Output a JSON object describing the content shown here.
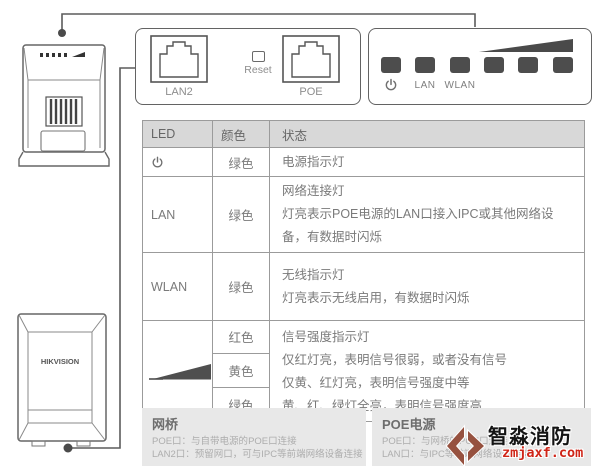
{
  "port_panel": {
    "lan2_label": "LAN2",
    "reset_label": "Reset",
    "poe_label": "POE"
  },
  "led_panel": {
    "power_icon": "power-icon",
    "lan_label": "LAN",
    "wlan_label": "WLAN",
    "signal_icon": "signal-strength-triangle"
  },
  "table": {
    "headers": {
      "led": "LED",
      "color": "颜色",
      "status": "状态"
    },
    "rows": [
      {
        "led": "power-icon",
        "color": "绿色",
        "status": [
          "电源指示灯"
        ]
      },
      {
        "led": "LAN",
        "color": "绿色",
        "status": [
          "网络连接灯",
          "灯亮表示POE电源的LAN口接入IPC或其他网络设备，有数据时闪烁"
        ]
      },
      {
        "led": "WLAN",
        "color": "绿色",
        "status": [
          "无线指示灯",
          "灯亮表示无线启用，有数据时闪烁"
        ]
      },
      {
        "led": "signal-strength-triangle",
        "colors": [
          "红色",
          "黄色",
          "绿色"
        ],
        "status": [
          "信号强度指示灯",
          "仅红灯亮，表明信号很弱，或者没有信号",
          "仅黄、红灯亮，表明信号强度中等",
          "黄、红、绿灯全亮，表明信号强度高"
        ]
      }
    ]
  },
  "footers": {
    "bridge": {
      "title": "网桥",
      "lines": [
        "POE口：与自带电源的POE口连接",
        "LAN2口：预留网口，可与IPC等前端网络设备连接"
      ]
    },
    "poe": {
      "title": "POE电源",
      "lines": [
        "POE口：与网桥的POE口连接",
        "LAN口：与IPC等前端网络设备连接"
      ]
    }
  },
  "devices": {
    "bottom_device_label": "HIKVISION"
  },
  "watermark": {
    "brand": "智淼消防",
    "site": "zmjaxf.com"
  },
  "colors": {
    "led_dark": "#4d4d4d",
    "header_bg": "#d8d8d8",
    "box_bg": "#e8e8e8",
    "watermark_red": "#cf2518",
    "logo_brown": "#96513f",
    "line_gray": "#5c5c5c"
  }
}
